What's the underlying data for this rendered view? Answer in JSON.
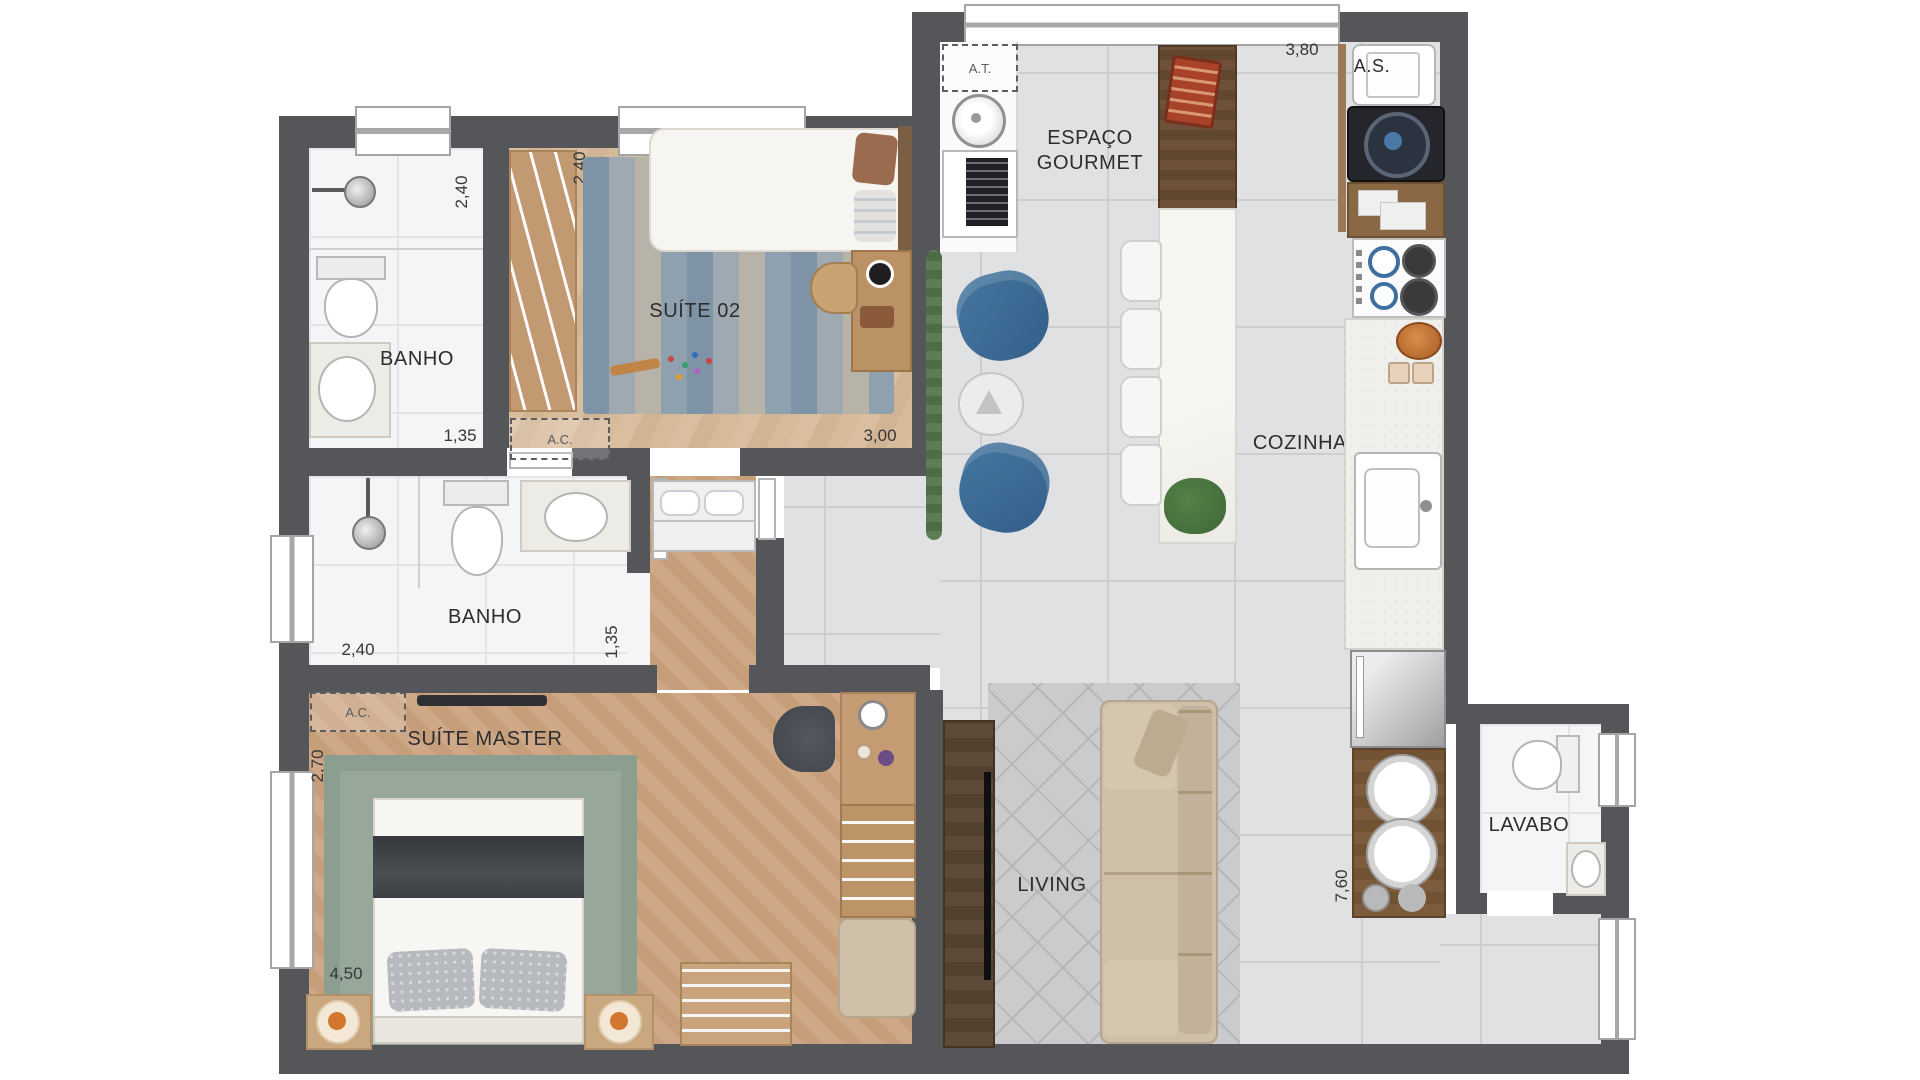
{
  "rooms": {
    "banho_suite02": {
      "label": "BANHO"
    },
    "suite02": {
      "label": "SUÍTE 02"
    },
    "espaco_gourmet": {
      "line1": "ESPAÇO",
      "line2": "GOURMET"
    },
    "cozinha": {
      "label": "COZINHA"
    },
    "area_de_servico": {
      "label": "A.S."
    },
    "banho_master": {
      "label": "BANHO"
    },
    "suite_master": {
      "label": "SUÍTE MASTER"
    },
    "living": {
      "label": "LIVING"
    },
    "lavabo": {
      "label": "LAVABO"
    }
  },
  "annotations": {
    "at_box": {
      "label": "A.T."
    },
    "ac_suite02": {
      "label": "A.C."
    },
    "ac_suite_master": {
      "label": "A.C."
    }
  },
  "dimensions": {
    "banho_suite02_width": "2,40",
    "banho_suite02_depth": "1,35",
    "suite02_closet_width": "2,40",
    "suite02_width": "3,00",
    "gourmet_width": "3,80",
    "banho_master_width": "2,40",
    "banho_master_depth": "1,35",
    "suite_master_depth": "2,70",
    "suite_master_width": "4,50",
    "kitchen_length": "7,60"
  },
  "colors": {
    "wall": "#54565A",
    "tile_floor": "#E0E1E2",
    "wood_floor": "#CFA987",
    "accent_chair_blue": "#3A6B95",
    "rug_green": "#97A79A",
    "rug_gray": "#C9CBCD"
  }
}
